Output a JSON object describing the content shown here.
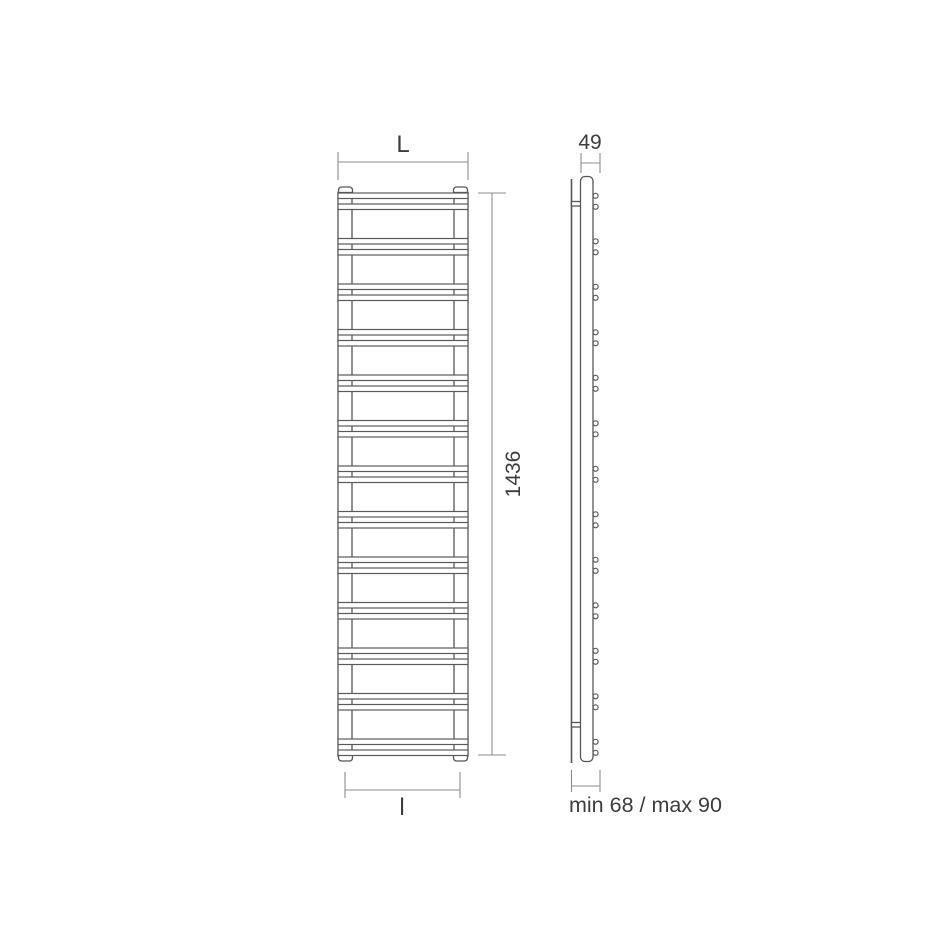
{
  "figure": {
    "kind": "towel-radiator-technical-drawing",
    "front_view": {
      "width_dim_label": "L",
      "height_dim_label": "1436",
      "bottom_width_dim_label": "l",
      "rung_pair_count": 13,
      "bars_per_group": 2
    },
    "side_view": {
      "depth_dim_label": "49",
      "wall_distance_dim_label": "min 68 / max 90",
      "tube_end_pair_count": 13,
      "bracket_count": 2
    },
    "colors": {
      "line": "#575757",
      "dimension_line": "#8c8c8c",
      "text": "#3d3d3d",
      "background": "#ffffff"
    }
  }
}
